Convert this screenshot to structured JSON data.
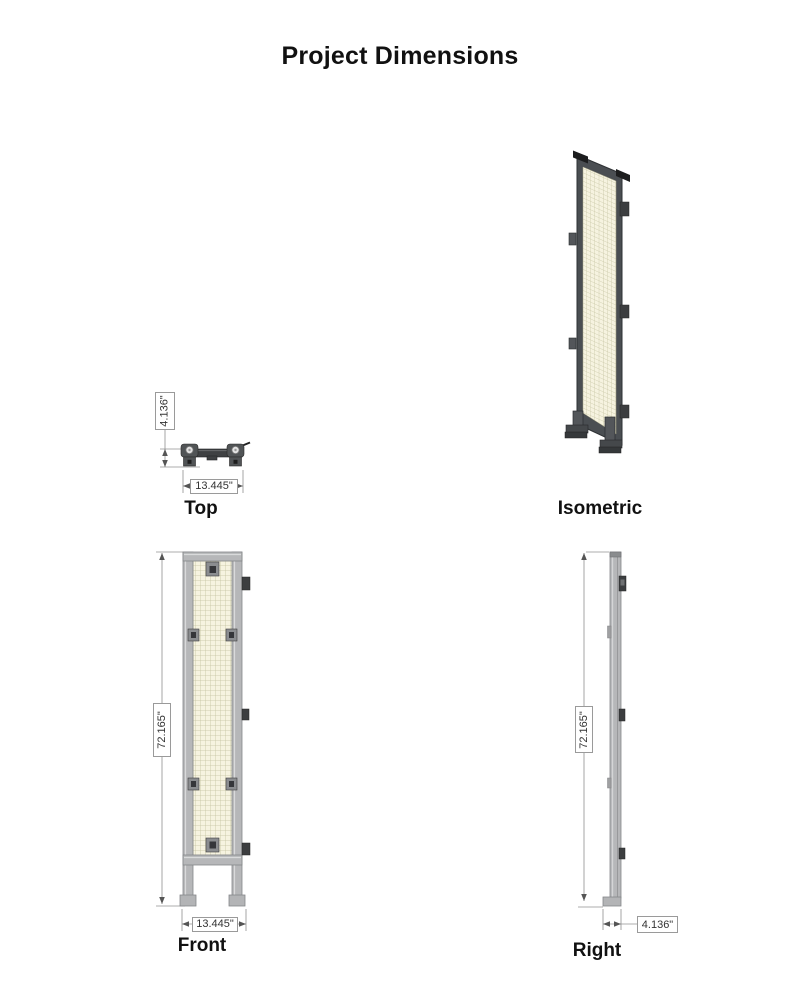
{
  "title": "Project Dimensions",
  "views": {
    "top": {
      "label": "Top",
      "dim_depth": "4.136\"",
      "dim_width": "13.445\""
    },
    "isometric": {
      "label": "Isometric"
    },
    "front": {
      "label": "Front",
      "dim_height": "72.165\"",
      "dim_width": "13.445\""
    },
    "right": {
      "label": "Right",
      "dim_height": "72.165\"",
      "dim_depth": "4.136\""
    }
  },
  "colors": {
    "mesh_bg": "#f6f3e0",
    "mesh_line": "#c4c2a0",
    "frame_light": "#b6b7b9",
    "frame_outline": "#85878a",
    "metal_dark": "#3f4143",
    "iso_frame": "#4a4e52",
    "dim_line": "#909090",
    "text": "#111111"
  }
}
